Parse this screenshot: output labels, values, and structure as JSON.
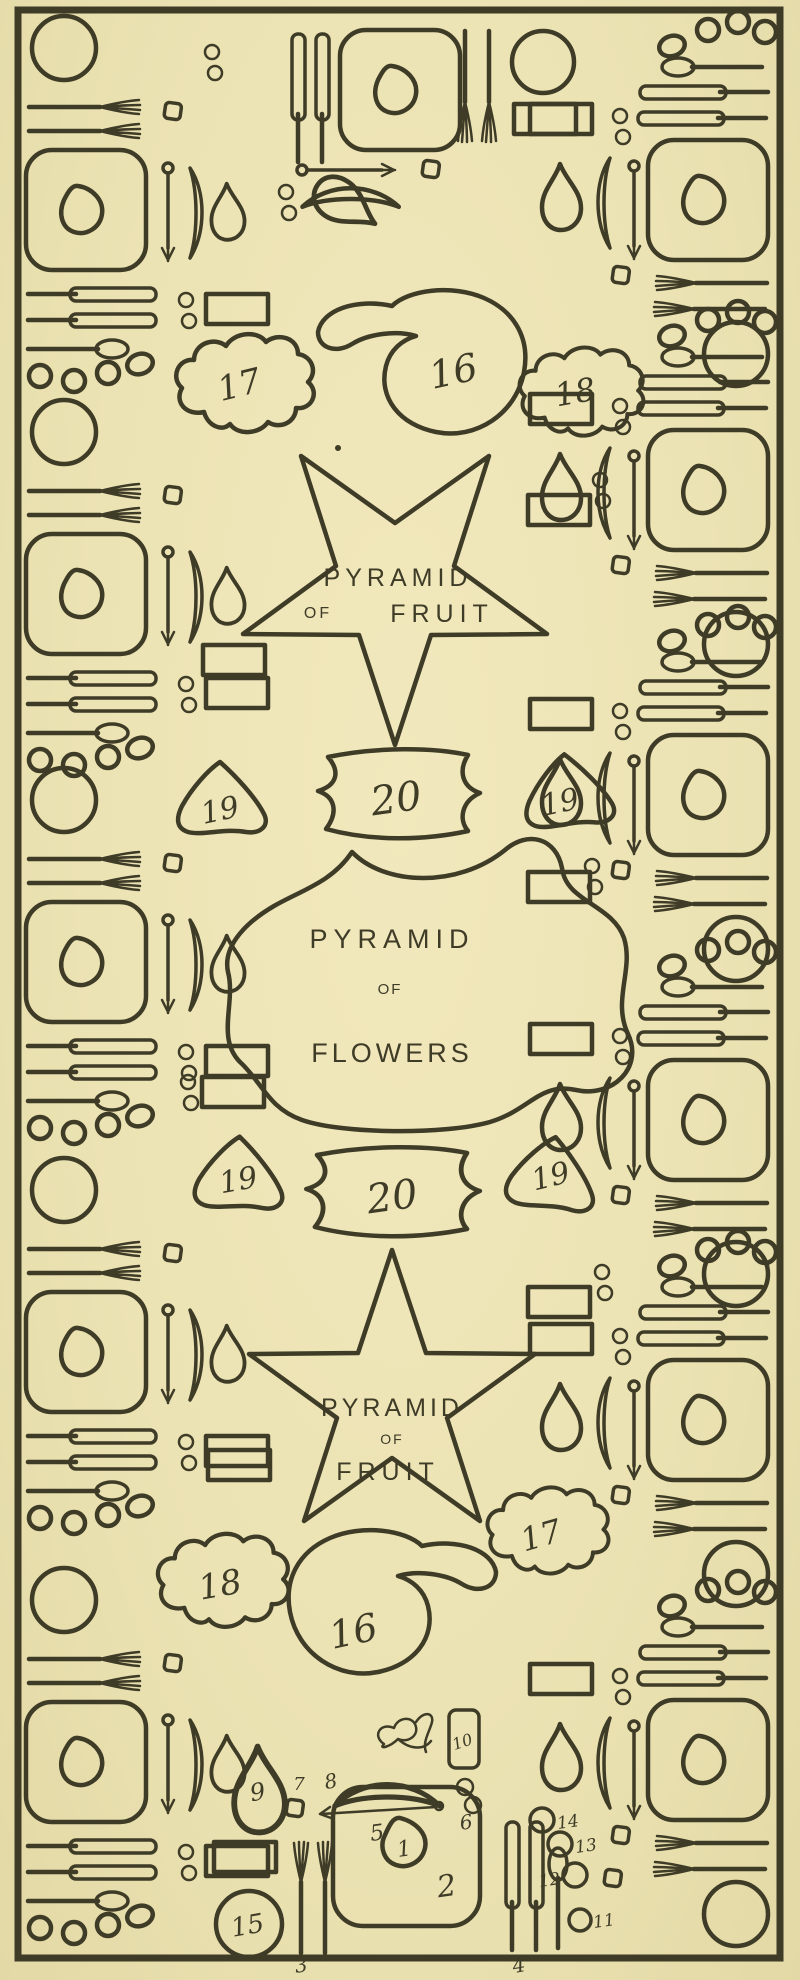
{
  "colors": {
    "paper": "#ece3b4",
    "ink": "#3e3b27"
  },
  "pyramids": {
    "fruit_top": {
      "line1": "PYRAMID",
      "line2": "OF",
      "line3": "FRUIT"
    },
    "flowers": {
      "line1": "PYRAMID",
      "line2": "OF",
      "line3": "FLOWERS"
    },
    "fruit_bottom": {
      "line1": "PYRAMID",
      "line2": "OF",
      "line3": "FRUIT"
    }
  },
  "numbers": {
    "cloud_top_left": "17",
    "paisley_top": "16",
    "cloud_top_right": "18",
    "dish_row1_left": "19",
    "dish_row1_center": "20",
    "dish_row1_right": "19",
    "dish_row2_left": "19",
    "dish_row2_center": "20",
    "dish_row2_right": "19",
    "cloud_bottom_left": "18",
    "paisley_bottom": "16",
    "cloud_bottom_right": "17"
  },
  "key_items": {
    "napkin": "1",
    "plate": "2",
    "forks": "3",
    "knives_spoon": "4",
    "skewer": "5",
    "casters": "6",
    "salt_cellar": "7",
    "roll": "8",
    "water_carafe": "9",
    "menu_card": "10",
    "glass_11": "11",
    "glass_12": "12",
    "glass_13": "13",
    "glass_14": "14",
    "bread_plate": "15"
  }
}
